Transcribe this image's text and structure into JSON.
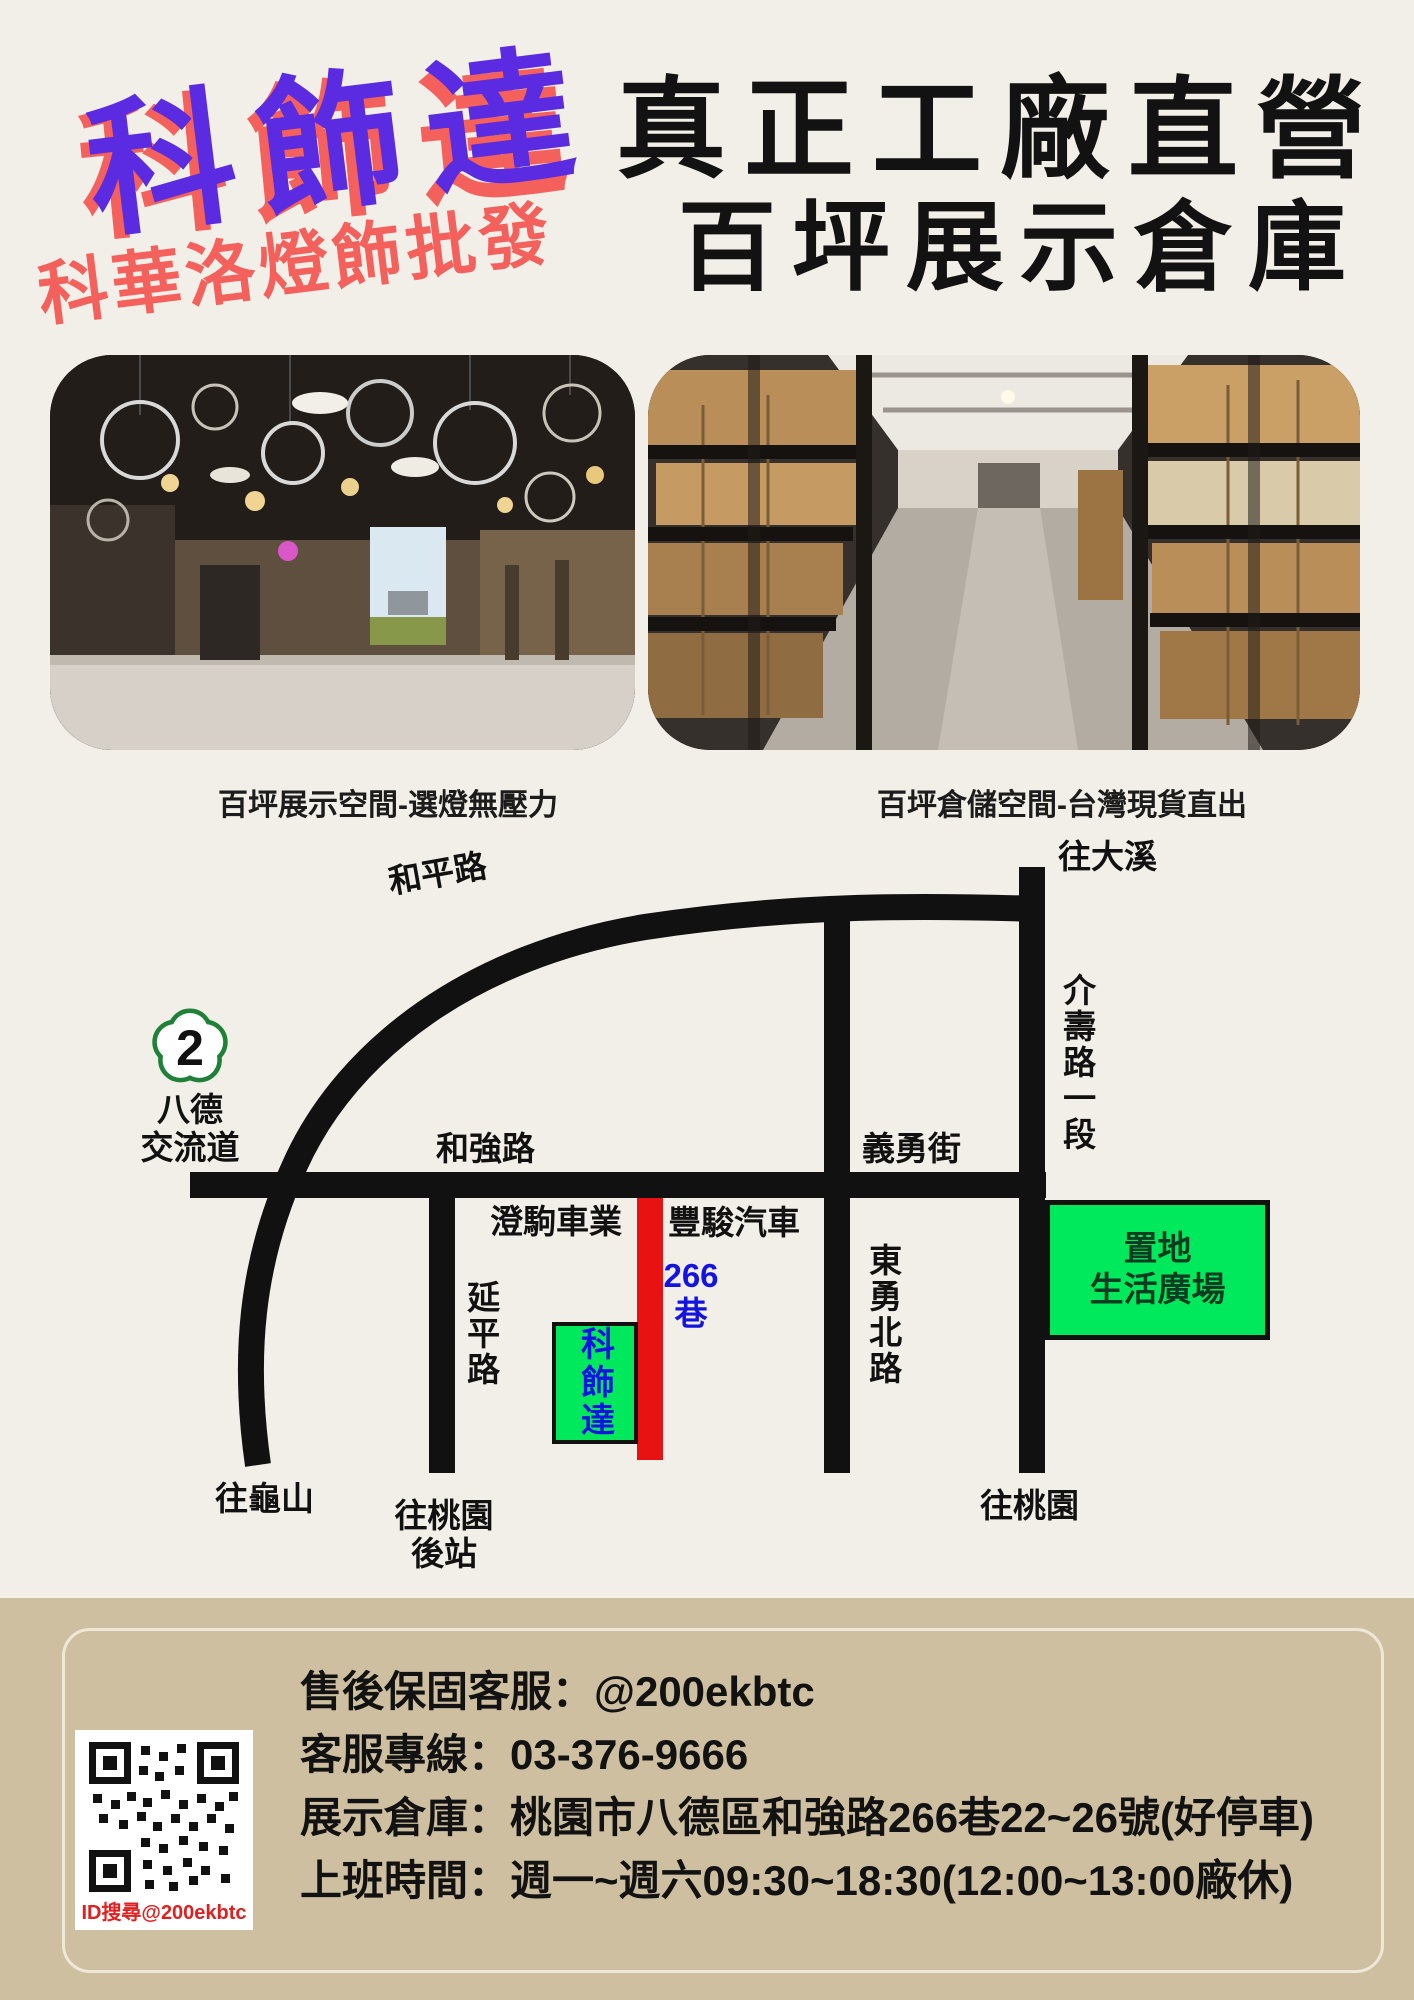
{
  "colors": {
    "background": "#F2EFE8",
    "brand_purple": "#5A2BE0",
    "brand_coral": "#F4605C",
    "map_road": "#111111",
    "lane_red": "#E81212",
    "landmark_green": "#00E95D",
    "lane_text_blue": "#1414E0",
    "footer_tan": "#CDBFA0",
    "shield_green": "#1F8038"
  },
  "header": {
    "brand_title": "科飾達",
    "brand_subtitle": "科華洛燈飾批發",
    "headline_line1": "真正工廠直營",
    "headline_line2": "百坪展示倉庫"
  },
  "photos": {
    "left_caption": "百坪展示空間-選燈無壓力",
    "right_caption": "百坪倉儲空間-台灣現貨直出"
  },
  "map": {
    "badge": {
      "number": "2",
      "name": "八德\n交流道"
    },
    "roads": {
      "heping": "和平路",
      "heqiang": "和強路",
      "yiyong": "義勇街",
      "yanping": "延平路",
      "dongyongbei": "東勇北路",
      "jieshou": "介壽路一段",
      "lane266": "266\n巷"
    },
    "directions": {
      "daxi": "往大溪",
      "guishan": "往龜山",
      "taoyuan_rear": "往桃園\n後站",
      "taoyuan": "往桃園"
    },
    "landmarks": {
      "chengju": "澄駒車業",
      "fengjun": "豐駿汽車",
      "store": "科飾達",
      "plaza": "置地\n生活廣場"
    }
  },
  "footer": {
    "qr_label": "ID搜尋@200ekbtc",
    "lines": [
      "售後保固客服：@200ekbtc",
      "客服專線：03-376-9666",
      "展示倉庫：桃園市八德區和強路266巷22~26號(好停車)",
      "上班時間：週一~週六09:30~18:30(12:00~13:00廠休)"
    ]
  }
}
